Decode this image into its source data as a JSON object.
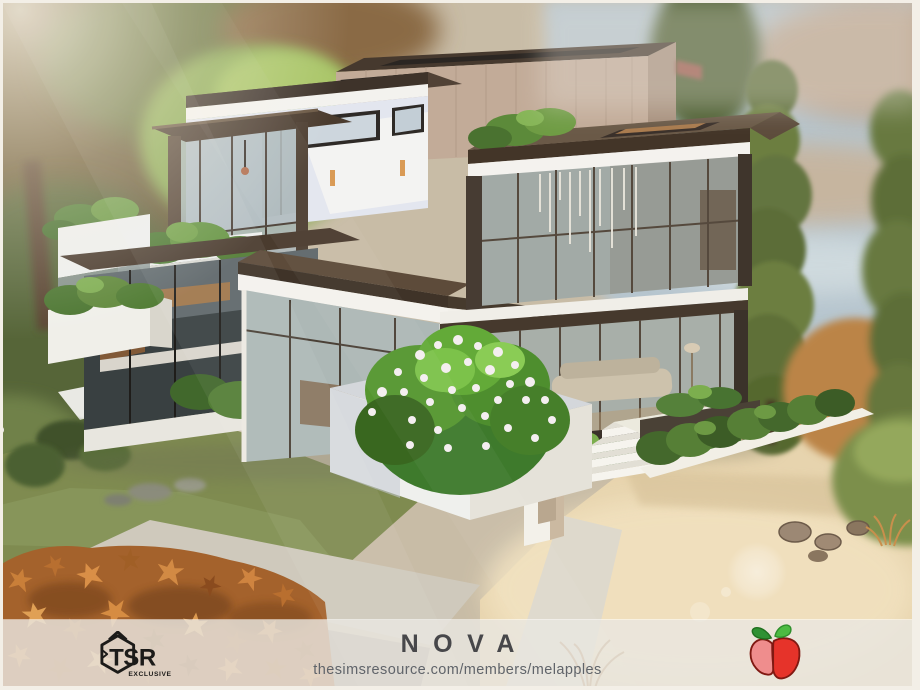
{
  "footer": {
    "title": "NOVA",
    "url": "thesimsresource.com/members/melapples",
    "tsr_logo_text": "TSR",
    "tsr_logo_subtext": "EXCLUSIVE"
  },
  "icons": {
    "tsr": "tsr-exclusive-hexagon-logo",
    "apple": "melapples-red-apple-logo"
  },
  "colors": {
    "title_text": "#47474a",
    "url_text": "#60646a",
    "footer_bar": "rgba(233,230,224,0.82)",
    "logo_black": "#1c1b19",
    "apple_red": "#e6332a",
    "apple_pink": "#ef8d8d",
    "apple_leaf_dark": "#2f9133",
    "apple_leaf_light": "#4cbb42",
    "roof_brown": "#4a3b2e",
    "wall_white": "#f2f0ea",
    "glass_blue": "#a8b2b0",
    "foliage_green": "#55803a",
    "sand": "#e9d6b1",
    "water": "#b6c5ce",
    "autumn_orange": "#c07a3e"
  }
}
